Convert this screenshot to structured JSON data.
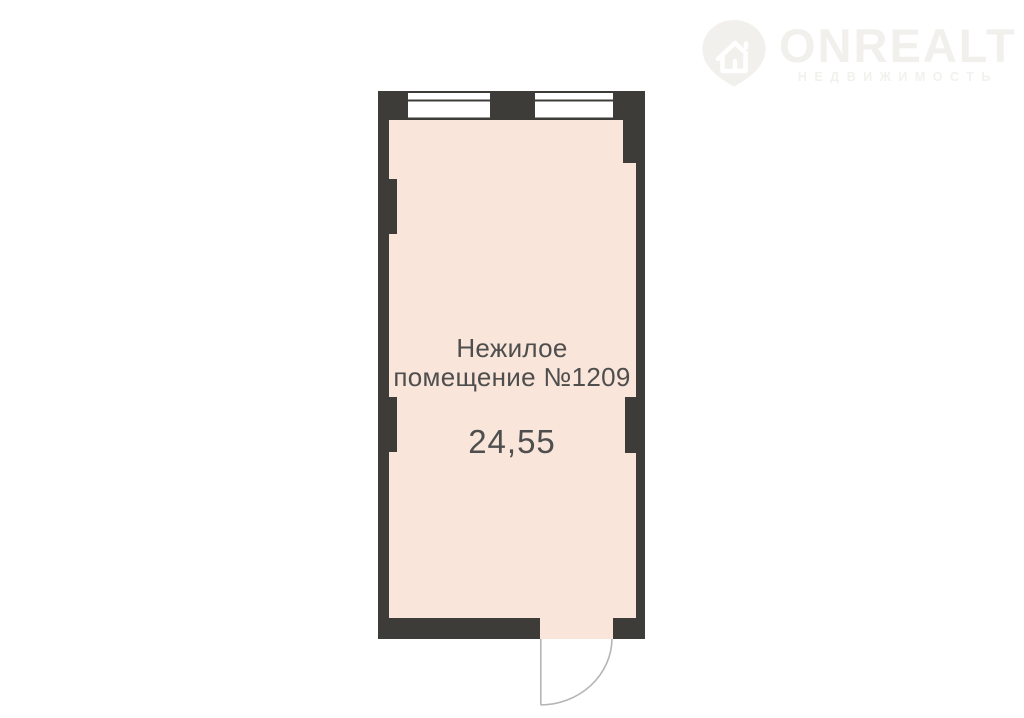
{
  "watermark": {
    "brand": "ONREALT",
    "tagline": "НЕДВИЖИМОСТЬ",
    "icon": "house-pin-icon"
  },
  "floorplan": {
    "room_label_line1": "Нежилое",
    "room_label_line2": "помещение №1209",
    "area_value": "24,55"
  },
  "colors": {
    "wall": "#3d3c38",
    "floor": "#f9e5d9",
    "window_fill": "#ffffff",
    "window_line": "#3d3c38",
    "door_line": "#b5b5b5",
    "label": "#4e4e4e",
    "watermark": "#f1f0ed",
    "background": "#ffffff"
  }
}
